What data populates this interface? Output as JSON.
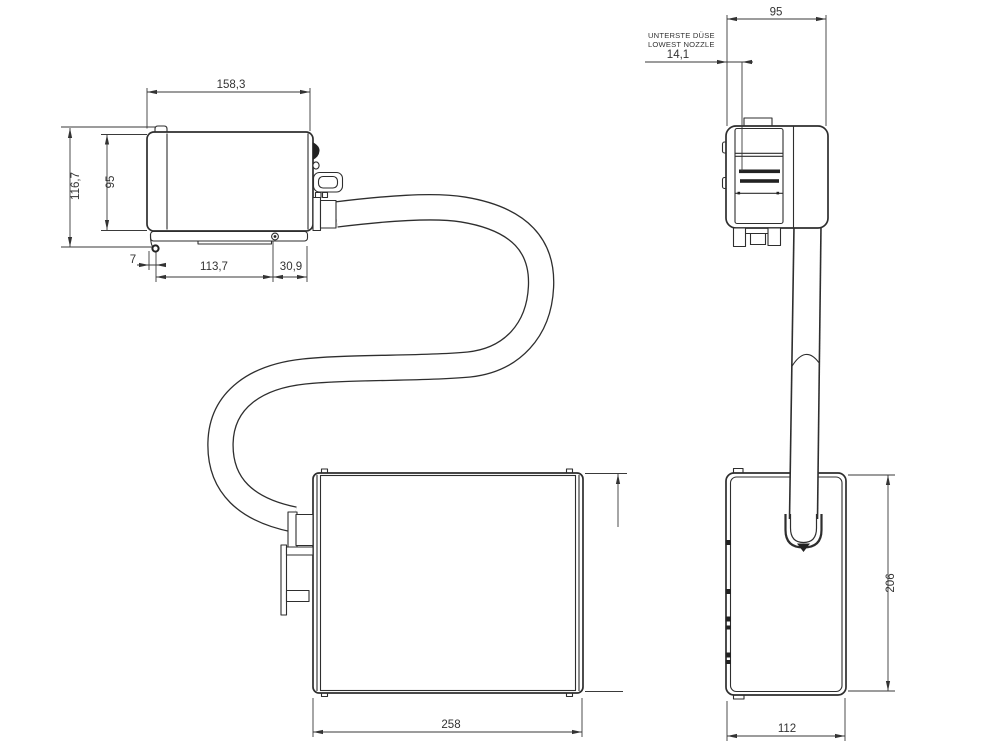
{
  "colors": {
    "background": "#ffffff",
    "outline": "#2e2e2e",
    "dimension_lines": "#3a3a3a",
    "text": "#333333"
  },
  "dimensions": {
    "left": {
      "total_width": "158,3",
      "total_height": "116,7",
      "body_height": "95",
      "lowest_point_offset": "7",
      "base_plate_length": "113,7",
      "connector_length": "30,9",
      "tank_length": "258"
    },
    "right": {
      "head_width": "95",
      "lowest_nozzle_offset": "14,1",
      "tank_height": "206",
      "tank_depth": "112"
    }
  },
  "notes": {
    "nozzle_de": "UNTERSTE DÜSE",
    "nozzle_en": "LOWEST NOZZLE"
  }
}
